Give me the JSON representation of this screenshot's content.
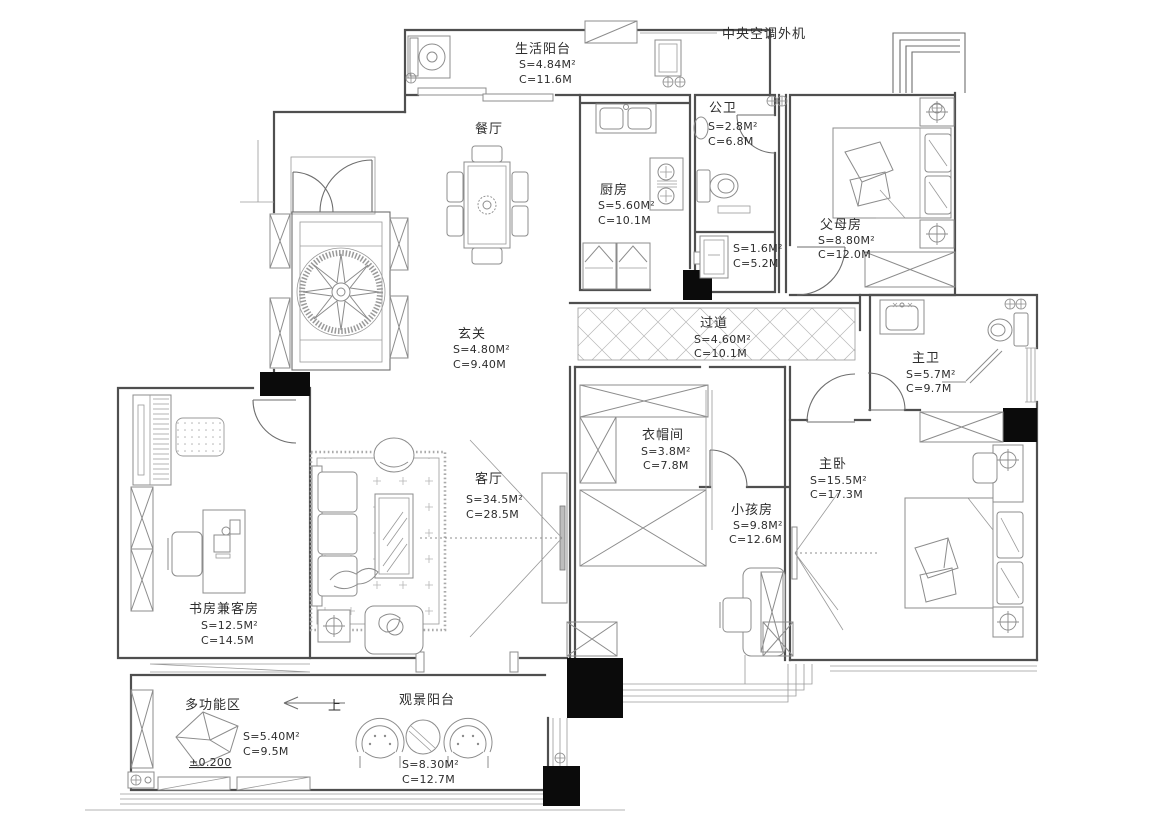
{
  "annotations": {
    "ac_unit": "中央空调外机",
    "up": "上",
    "level": "±0.200"
  },
  "rooms": {
    "life_balcony": {
      "name": "生活阳台",
      "s": "S=4.84M²",
      "c": "C=11.6M"
    },
    "dining": {
      "name": "餐厅"
    },
    "kitchen": {
      "name": "厨房",
      "s": "S=5.60M²",
      "c": "C=10.1M"
    },
    "public_bath": {
      "name": "公卫",
      "s": "S=2.8M²",
      "c": "C=6.8M"
    },
    "parents_room": {
      "name": "父母房",
      "s": "S=8.80M²",
      "c": "C=12.0M"
    },
    "storage": {
      "s": "S=1.6M²",
      "c": "C=5.2M"
    },
    "foyer": {
      "name": "玄关",
      "s": "S=4.80M²",
      "c": "C=9.40M"
    },
    "hallway": {
      "name": "过道",
      "s": "S=4.60M²",
      "c": "C=10.1M"
    },
    "master_bath": {
      "name": "主卫",
      "s": "S=5.7M²",
      "c": "C=9.7M"
    },
    "cloakroom": {
      "name": "衣帽间",
      "s": "S=3.8M²",
      "c": "C=7.8M"
    },
    "living_room": {
      "name": "客厅",
      "s": "S=34.5M²",
      "c": "C=28.5M"
    },
    "kids_room": {
      "name": "小孩房",
      "s": "S=9.8M²",
      "c": "C=12.6M"
    },
    "master_bedroom": {
      "name": "主卧",
      "s": "S=15.5M²",
      "c": "C=17.3M"
    },
    "study": {
      "name": "书房兼客房",
      "s": "S=12.5M²",
      "c": "C=14.5M"
    },
    "multi_zone": {
      "name": "多功能区",
      "s": "S=5.40M²",
      "c": "C=9.5M"
    },
    "view_balcony": {
      "name": "观景阳台",
      "s": "S=8.30M²",
      "c": "C=12.7M"
    }
  }
}
